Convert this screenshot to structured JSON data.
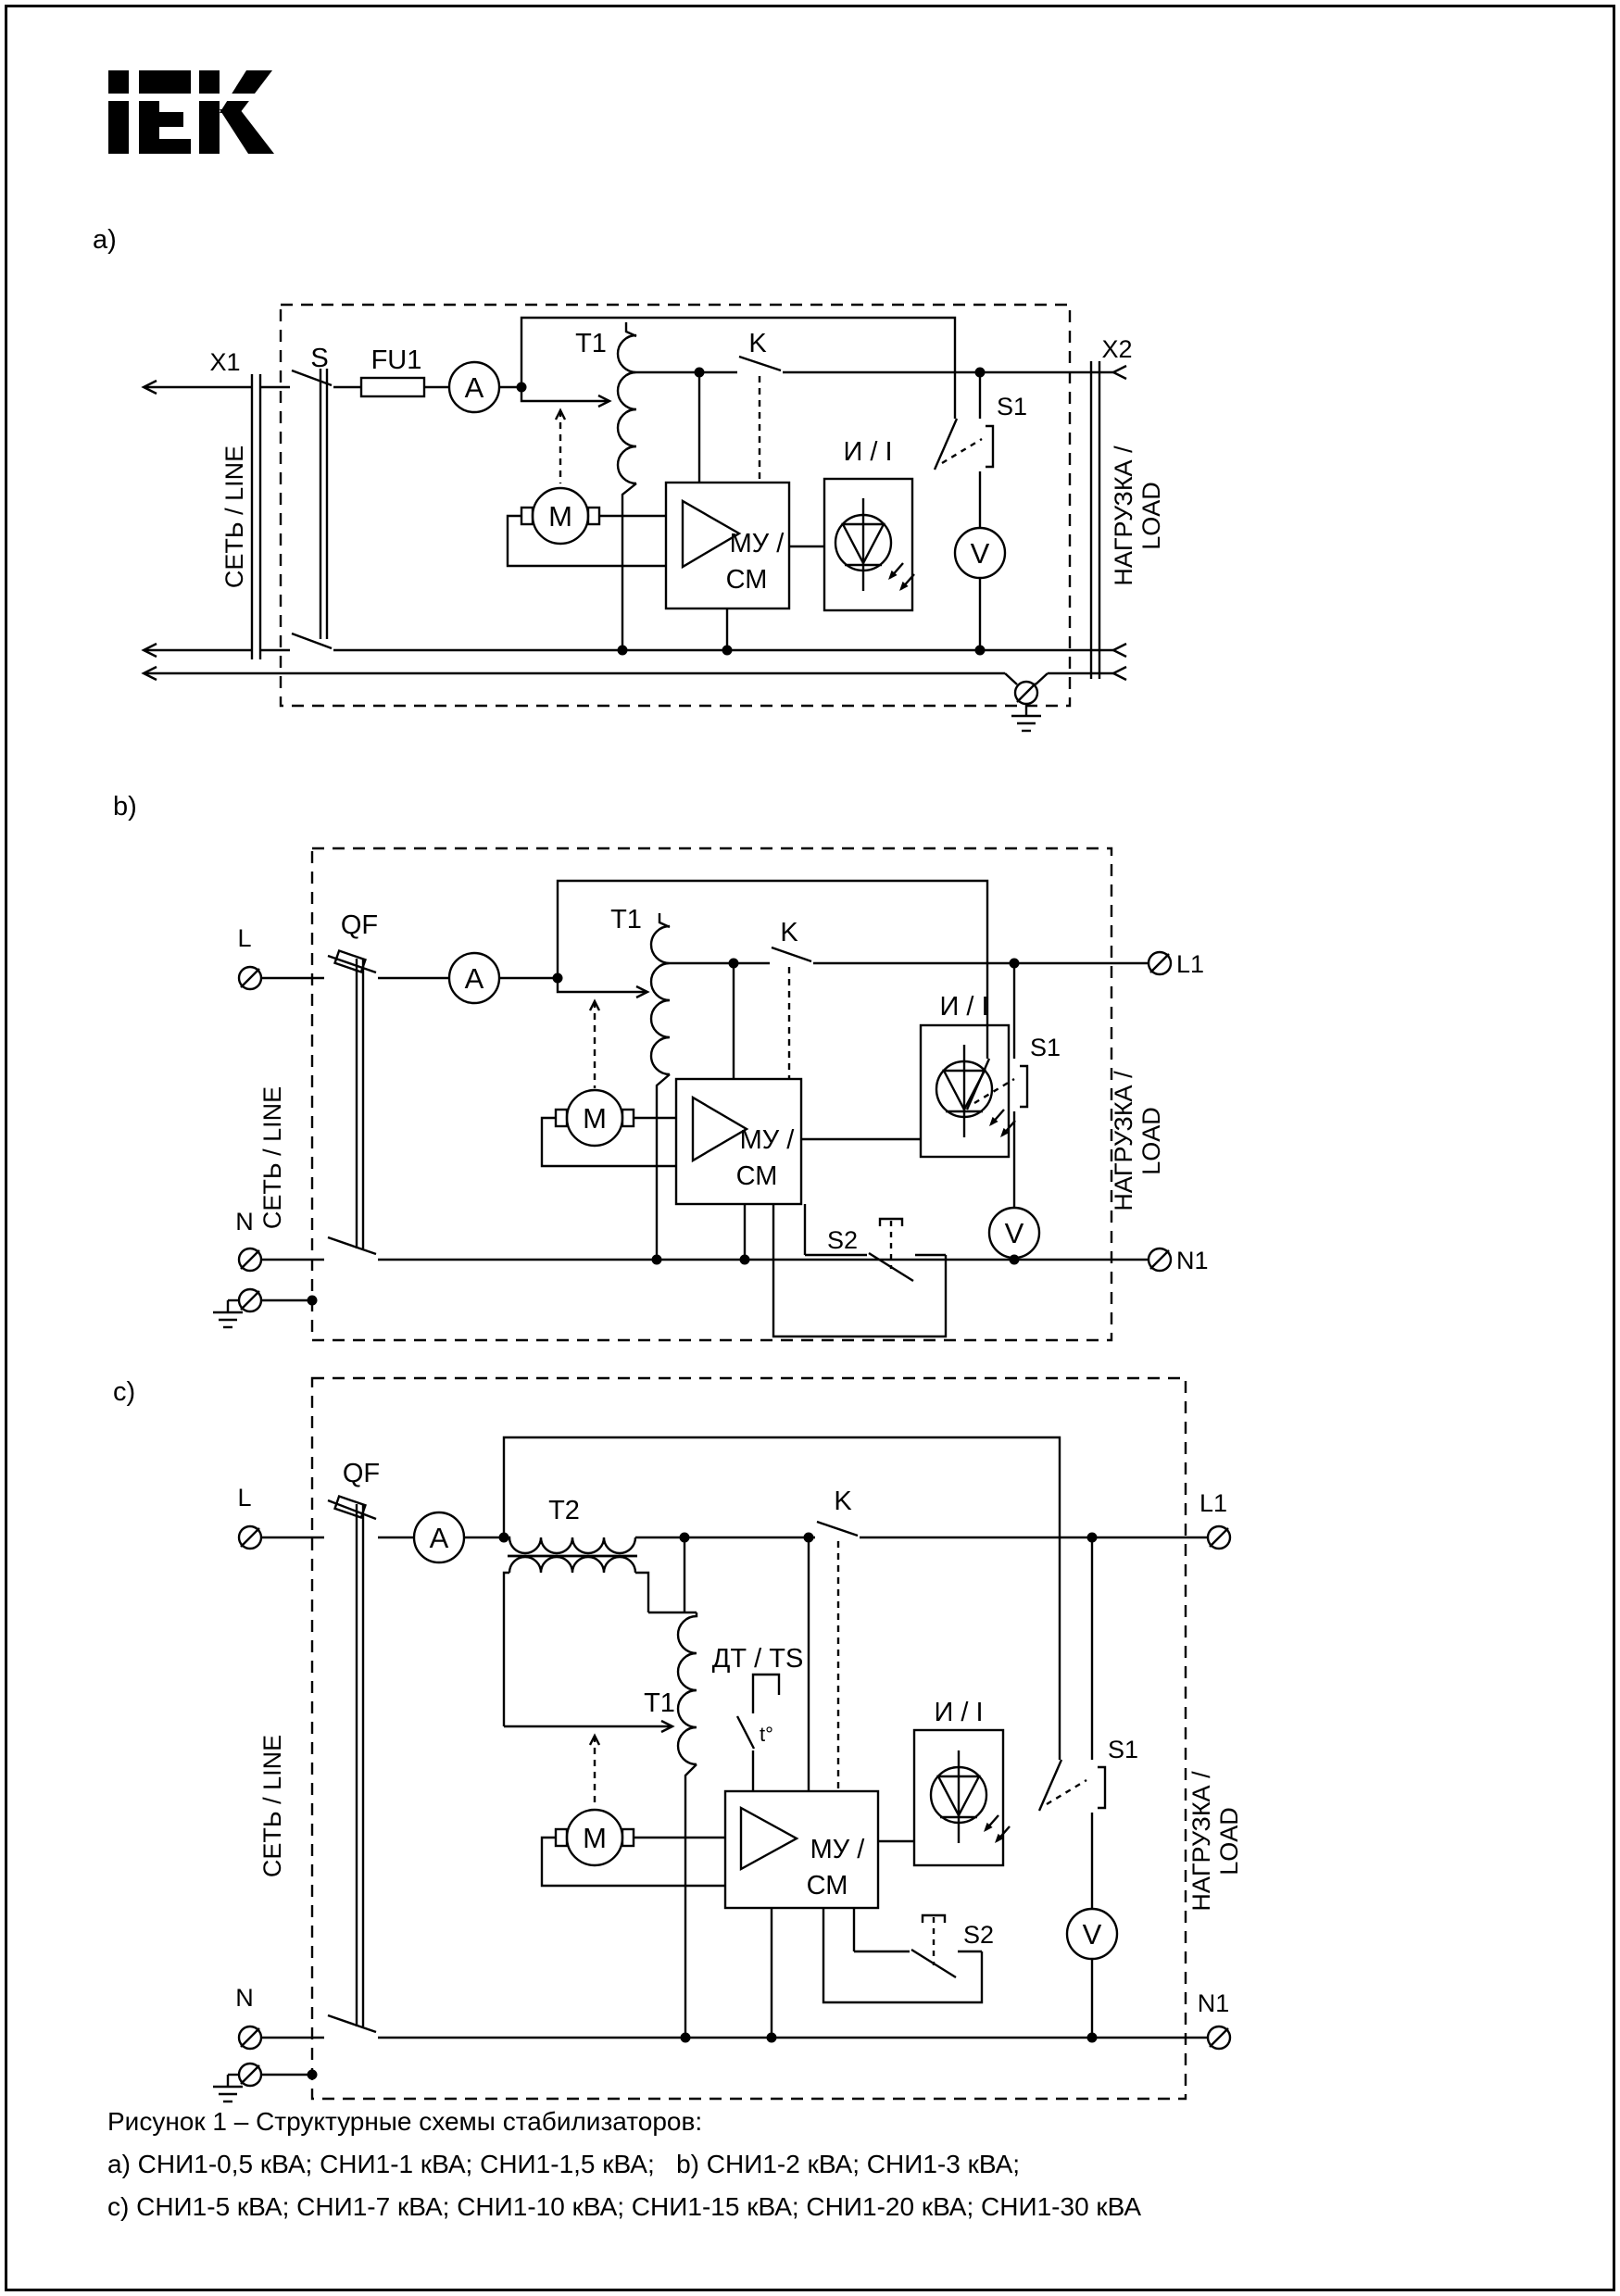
{
  "brand": {
    "logo": "IEK"
  },
  "caption": {
    "line1": "Рисунок 1 – Структурные схемы стабилизаторов:",
    "line2": "a) СНИ1-0,5 кВА; СНИ1-1 кВА; СНИ1-1,5 кВА;   b) СНИ1-2 кВА; СНИ1-3 кВА;",
    "line3": "c) СНИ1-5 кВА; СНИ1-7 кВА; СНИ1-10 кВА; СНИ1-15 кВА; СНИ1-20 кВА; СНИ1-30 кВА"
  },
  "diagram_a": {
    "label": "a)",
    "terminal_in": "X1",
    "terminal_out": "X2",
    "line_label": "СЕТЬ / LINE",
    "load_label_1": "НАГРУЗКА /",
    "load_label_2": "LOAD",
    "switch": "S",
    "fuse": "FU1",
    "ammeter": "A",
    "transformer": "T1",
    "contactor": "K",
    "motor": "M",
    "control_block_1": "МУ /",
    "control_block_2": "СМ",
    "indicator": "И / I",
    "selector": "S1",
    "voltmeter": "V"
  },
  "diagram_b": {
    "label": "b)",
    "terminal_l": "L",
    "terminal_n": "N",
    "terminal_l1": "L1",
    "terminal_n1": "N1",
    "line_label": "СЕТЬ / LINE",
    "load_label_1": "НАГРУЗКА /",
    "load_label_2": "LOAD",
    "breaker": "QF",
    "ammeter": "A",
    "transformer": "T1",
    "contactor": "K",
    "motor": "M",
    "control_block_1": "МУ /",
    "control_block_2": "СМ",
    "indicator": "И / I",
    "selector": "S1",
    "aux_switch": "S2",
    "voltmeter": "V"
  },
  "diagram_c": {
    "label": "c)",
    "terminal_l": "L",
    "terminal_n": "N",
    "terminal_l1": "L1",
    "terminal_n1": "N1",
    "line_label": "СЕТЬ / LINE",
    "load_label_1": "НАГРУЗКА /",
    "load_label_2": "LOAD",
    "breaker": "QF",
    "ammeter": "A",
    "series_transformer": "T2",
    "transformer": "T1",
    "temp_sensor": "ДТ / TS",
    "temp_mark": "t°",
    "contactor": "K",
    "motor": "M",
    "control_block_1": "МУ /",
    "control_block_2": "СМ",
    "indicator": "И / I",
    "selector": "S1",
    "aux_switch": "S2",
    "voltmeter": "V"
  }
}
